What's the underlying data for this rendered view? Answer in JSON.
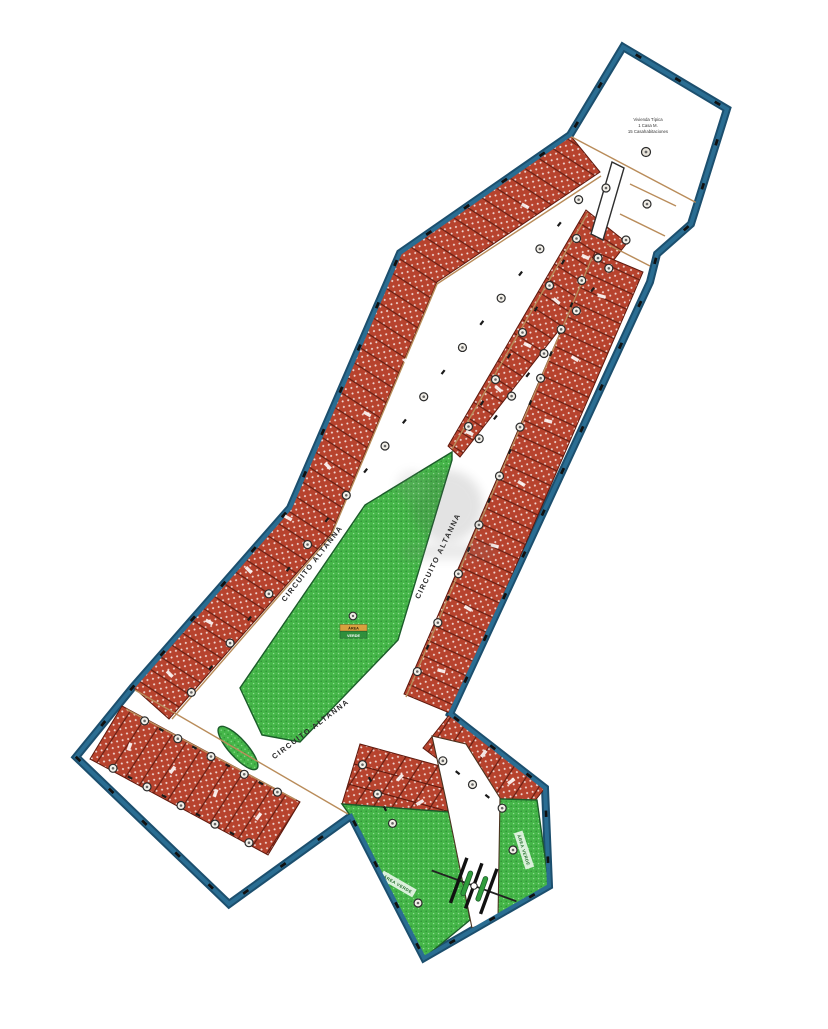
{
  "plan": {
    "street_name": "CIRCUITO ALTANNA",
    "info_block": {
      "line1": "Vivienda Típica",
      "line2": "1 Casa M.",
      "line3": "15 Casahabitaciones"
    },
    "median_sign": {
      "line1": "ÁREA",
      "line2": "VERDE"
    },
    "park_label": "ÁREA VERDE"
  },
  "colors": {
    "border": "#1c4f6e",
    "border2": "#2a6d92",
    "lot": "#b7432e",
    "lotline": "#5f1a0e",
    "green": "#45b649",
    "greendot": "#2f8f35",
    "tan": "#b98c5a",
    "ink": "#2b2b2b"
  }
}
